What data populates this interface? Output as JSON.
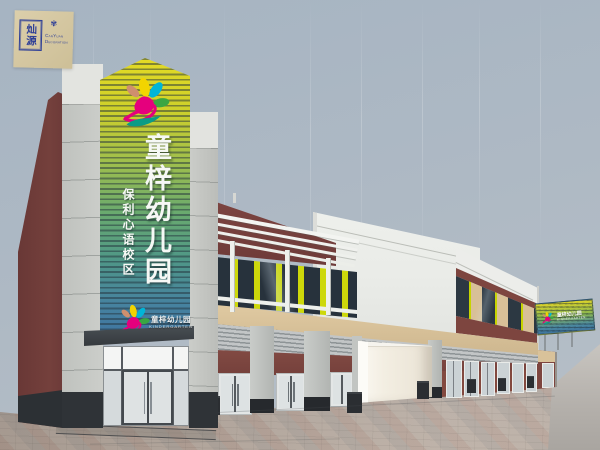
{
  "watermark": {
    "seal_text": "灿源",
    "brand_name": "CanYuan Decoration",
    "ornament_glyph": "✾"
  },
  "tower_sign": {
    "main_text": "童梓幼儿园",
    "sub_text": "保利心语校区",
    "logo_icon": "flower-dancer-logo",
    "stripe_top_color": "#ddd42a",
    "stripe_mid_color": "#6fae6e",
    "stripe_bottom_color": "#3f74a0"
  },
  "entrance_sign": {
    "name_cn": "童梓幼儿园",
    "name_en": "KINDERGARTEN"
  },
  "billboard_sign": {
    "name_cn": "童梓幼儿园",
    "name_en": "KINDERGARTEN",
    "logo_icon": "flower-dancer-logo"
  },
  "palette": {
    "sky": "#aab8c4",
    "maroon_wall": "#74403c",
    "stone_gray": "#c6c8c4",
    "accent_chartreuse": "#c9d402",
    "tan_band": "#d8c098",
    "white_trim": "#ebece8",
    "canopy_dark": "#41464b",
    "logo_magenta": "#e5007d",
    "logo_cyan": "#00b5d8",
    "logo_green": "#3aa643",
    "logo_yellow": "#f2d400",
    "logo_teal": "#0b9c86",
    "logo_salmon": "#cf8f6e",
    "pavement": "#b3a79e"
  }
}
